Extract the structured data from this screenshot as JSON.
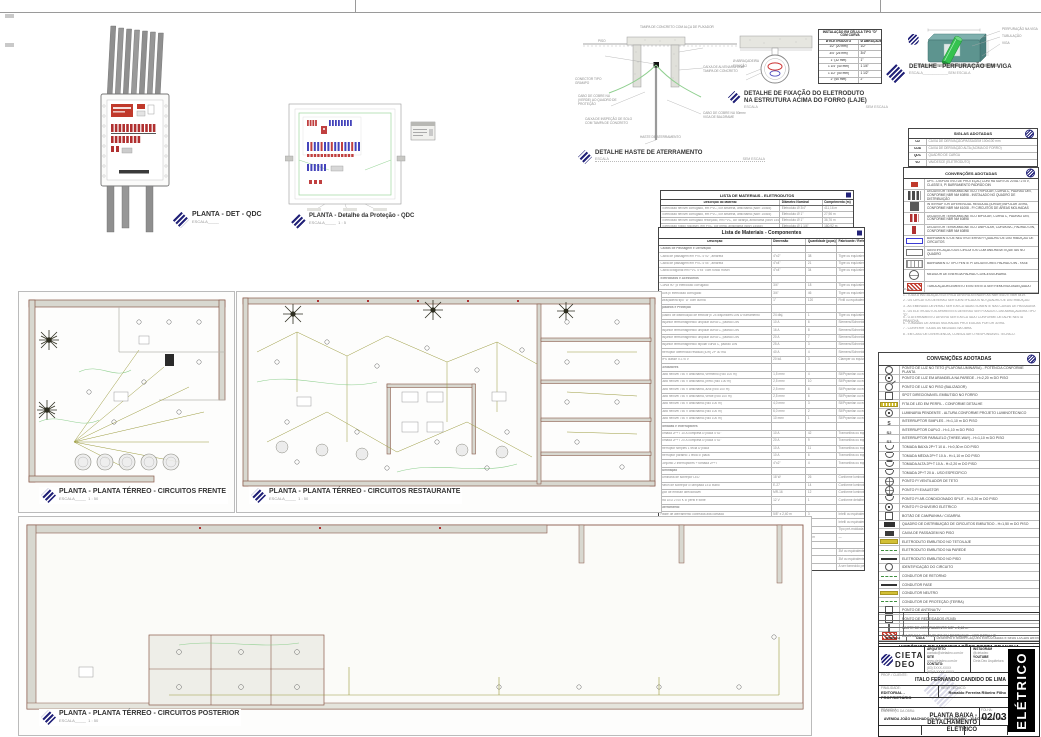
{
  "colors": {
    "accent_navy": "#232379",
    "breaker_red": "#b03030",
    "breaker_blue": "#4444bb",
    "wire_olive": "#9a9a3c",
    "wire_green": "#8fcf8f",
    "wall_brown": "#8a5a4a",
    "beam_teal": "#5d948f",
    "pipe_green": "#35c24f"
  },
  "top_details": {
    "qdc": {
      "title": "PLANTA - DET - QDC",
      "scale": "ESCALA_____"
    },
    "protecao": {
      "title": "PLANTA - Detalhe da Proteção - QDC",
      "scale": "ESCALA_____",
      "scale_value": "1 : 5"
    },
    "haste": {
      "title": "DETALHE HASTE DE ATERRAMENTO",
      "scale_left": "ESCALA",
      "scale_right": "SEM ESCALA",
      "labels": [
        "TAMPA DE CONCRETO COM ALÇA DE PUXADOR",
        "PISO",
        "CONECTOR TIPO GRAMPO",
        "CABO DE COBRE NU (VERDE) AO QUADRO DE PROTEÇÃO",
        "CAIXA DE INSPEÇÃO DE SOLO COM TAMPA DE CONCRETO",
        "CAIXA DE ALVENARIA COM TAMPA DE CONCRETO",
        "CABO DE COBRE NU 50mm² VIGA DE BALDRAME",
        "HASTE DE ATERRAMENTO"
      ]
    },
    "fixacao": {
      "title1": "DETALHE DE FIXAÇÃO DO ELETRODUTO",
      "title2": "NA ESTRUTURA ACIMA DO FORRO (LAJE)",
      "scale_left": "ESCALA",
      "scale_right": "SEM ESCALA",
      "label_left1": "Ø ABRAÇADEIRA",
      "label_left2": "FIXAÇÃO",
      "table": {
        "header": "INSTALAÇÃO EM CÉLULA TIPO \"D\" COM CURVA",
        "col1": "Ø ELETRODUTO",
        "col2": "Ø ABRAÇADEIRA",
        "rows": [
          {
            "e": "1/2\" (20 mm)",
            "a": "1/2\""
          },
          {
            "e": "3/4\" (25 mm)",
            "a": "3/4\""
          },
          {
            "e": "1\" (32 mm)",
            "a": "1\""
          },
          {
            "e": "1 1/4\" (40 mm)",
            "a": "1 1/4\""
          },
          {
            "e": "1 1/2\" (50 mm)",
            "a": "1 1/2\""
          },
          {
            "e": "2\" (60 mm)",
            "a": "2\""
          }
        ]
      }
    },
    "viga": {
      "title": "DETALHE - PERFURAÇÃO EM VIGA",
      "scale_left": "ESCALA_____________",
      "scale_right": "SEM ESCALA",
      "labels": [
        "PERFURAÇÃO NA VIGA",
        "TUBULAÇÃO",
        "VIGA"
      ]
    }
  },
  "plans": {
    "frente": {
      "title": "PLANTA - PLANTA TÉRREO - CIRCUITOS FRENTE",
      "scale": "ESCALA_____",
      "scale_value": "1 : 50"
    },
    "restaurante": {
      "title": "PLANTA - PLANTA TÉRREO - CIRCUITOS RESTAURANTE",
      "scale": "ESCALA_____",
      "scale_value": "1 : 50"
    },
    "posterior": {
      "title": "PLANTA - PLANTA TÉRREO - CIRCUITOS POSTERIOR",
      "scale": "ESCALA_____",
      "scale_value": "1 : 50"
    }
  },
  "materials_eletrodutos": {
    "title": "LISTA DE MATERIAIS - ELETRODUTOS",
    "headers": [
      "Descrição do Material",
      "Diâmetro Nominal",
      "Comprimento (m)"
    ],
    "rows": [
      {
        "d": "Eletroduto flexível corrugado, em PVC, cor amarela, antichama (NBR 15465)",
        "n": "Eletroduto Ø 3/4\"",
        "c": "411,16 m"
      },
      {
        "d": "Eletroduto flexível corrugado, em PVC, cor amarela, antichama (NBR 15465)",
        "n": "Eletroduto Ø 1\"",
        "c": "27,96 m"
      },
      {
        "d": "Eletroduto flexível corrugado reforçado, em PVC, cor laranja, antichama (NBR 15465)",
        "n": "Eletroduto Ø 1\"",
        "c": "36,76 m"
      },
      {
        "d": "Eletroduto rígido roscável, em PVC, cor preta, antichama (NBR 15465)",
        "n": "Eletroduto Ø 1 1/4\"",
        "c": "180,92 m"
      }
    ]
  },
  "materials_componentes": {
    "title": "Lista de Materiais - Componentes",
    "headers": [
      "Descrição",
      "Dimensão",
      "Quantidade (pças)",
      "Fabricante / Referência"
    ],
    "rows": [
      {
        "t": "sec",
        "d": "Caixas de Passagem e Derivação",
        "m": "",
        "q": "",
        "r": ""
      },
      {
        "t": "i",
        "d": "Caixa de passagem em PVC 4\"x2\", amarela",
        "m": "4\"x2\"",
        "q": "38",
        "r": "Tigre ou equivalente"
      },
      {
        "t": "i",
        "d": "Caixa de passagem em PVC 4\"x4\", amarela",
        "m": "4\"x4\"",
        "q": "21",
        "r": "Tigre ou equivalente"
      },
      {
        "t": "i",
        "d": "Caixa octogonal em PVC 4\"x4\" com fundo móvel",
        "m": "4\"x4\"",
        "q": "34",
        "r": "Tigre ou equivalente"
      },
      {
        "t": "sec",
        "d": "Eletrodutos e Acessórios",
        "m": "",
        "q": "",
        "r": ""
      },
      {
        "t": "i",
        "d": "Curva 90° p/ eletroduto corrugado",
        "m": "3/4\"",
        "q": "18",
        "r": "Tigre ou equivalente"
      },
      {
        "t": "i",
        "d": "Luva p/ eletroduto corrugado",
        "m": "3/4\"",
        "q": "46",
        "r": "Tigre ou equivalente"
      },
      {
        "t": "i",
        "d": "Abraçadeira tipo \"D\" com cunha",
        "m": "1\"",
        "q": "120",
        "r": "Fixtil ou equivalente"
      },
      {
        "t": "sec",
        "d": "Quadros e Proteção",
        "m": "",
        "q": "",
        "r": ""
      },
      {
        "t": "i",
        "d": "Quadro de distribuição de embutir p/ 24 disjuntores DIN c/ barramento",
        "m": "24 disj.",
        "q": "1",
        "r": "Tigre ou equivalente"
      },
      {
        "t": "i",
        "d": "Disjuntor termomagnético unipolar curva C, padrão DIN",
        "m": "10 A",
        "q": "6",
        "r": "Siemens/Schneider ou equiv."
      },
      {
        "t": "i",
        "d": "Disjuntor termomagnético unipolar curva C, padrão DIN",
        "m": "16 A",
        "q": "8",
        "r": "Siemens/Schneider ou equiv."
      },
      {
        "t": "i",
        "d": "Disjuntor termomagnético unipolar curva C, padrão DIN",
        "m": "20 A",
        "q": "7",
        "r": "Siemens/Schneider ou equiv."
      },
      {
        "t": "i",
        "d": "Disjuntor termomagnético bipolar curva C, padrão DIN",
        "m": "25 A",
        "q": "3",
        "r": "Siemens/Schneider ou equiv."
      },
      {
        "t": "i",
        "d": "Interruptor diferencial residual (IDR) 2P 30 mA",
        "m": "40 A",
        "q": "4",
        "r": "Siemens/Schneider ou equiv."
      },
      {
        "t": "i",
        "d": "DPS classe II 275 V",
        "m": "20 kA",
        "q": "3",
        "r": "Clamper ou equivalente"
      },
      {
        "t": "sec",
        "d": "Condutores",
        "m": "",
        "q": "",
        "r": ""
      },
      {
        "t": "i",
        "d": "Cabo flexível 750 V antichama, vermelho (rolo 100 m)",
        "m": "1,5 mm²",
        "q": "4",
        "r": "Sil/Prysmian ou equivalente"
      },
      {
        "t": "i",
        "d": "Cabo flexível 750 V antichama, preto (rolo 100 m)",
        "m": "2,5 mm²",
        "q": "10",
        "r": "Sil/Prysmian ou equivalente"
      },
      {
        "t": "i",
        "d": "Cabo flexível 750 V antichama, azul (rolo 100 m)",
        "m": "2,5 mm²",
        "q": "6",
        "r": "Sil/Prysmian ou equivalente"
      },
      {
        "t": "i",
        "d": "Cabo flexível 750 V antichama, verde (rolo 100 m)",
        "m": "2,5 mm²",
        "q": "6",
        "r": "Sil/Prysmian ou equivalente"
      },
      {
        "t": "i",
        "d": "Cabo flexível 750 V antichama (rolo 100 m)",
        "m": "4,0 mm²",
        "q": "3",
        "r": "Sil/Prysmian ou equivalente"
      },
      {
        "t": "i",
        "d": "Cabo flexível 750 V antichama (rolo 100 m)",
        "m": "6,0 mm²",
        "q": "2",
        "r": "Sil/Prysmian ou equivalente"
      },
      {
        "t": "i",
        "d": "Cabo flexível 750 V antichama (rolo 100 m)",
        "m": "10 mm²",
        "q": "1",
        "r": "Sil/Prysmian ou equivalente"
      },
      {
        "t": "sec",
        "d": "Tomadas e Interruptores",
        "m": "",
        "q": "",
        "r": ""
      },
      {
        "t": "i",
        "d": "Tomada 2P+T 10 A completa c/ placa 4\"x2\"",
        "m": "10 A",
        "q": "42",
        "r": "Tramontina ou equivalente"
      },
      {
        "t": "i",
        "d": "Tomada 2P+T 20 A completa c/ placa 4\"x2\"",
        "m": "20 A",
        "q": "9",
        "r": "Tramontina ou equivalente"
      },
      {
        "t": "i",
        "d": "Interruptor simples 1 tecla c/ placa",
        "m": "10 A",
        "q": "11",
        "r": "Tramontina ou equivalente"
      },
      {
        "t": "i",
        "d": "Interruptor paralelo 1 tecla c/ placa",
        "m": "10 A",
        "q": "6",
        "r": "Tramontina ou equivalente"
      },
      {
        "t": "i",
        "d": "Conjunto 2 interruptores + tomada 2P+T",
        "m": "4\"x2\"",
        "q": "4",
        "r": "Tramontina ou equivalente"
      },
      {
        "t": "sec",
        "d": "Iluminação",
        "m": "",
        "q": "",
        "r": ""
      },
      {
        "t": "i",
        "d": "Luminária de sobrepor LED",
        "m": "18 W",
        "q": "26",
        "r": "Conforme luminotécnico"
      },
      {
        "t": "i",
        "d": "Plafon de sobrepor c/ lâmpada LED bulbo",
        "m": "E-27",
        "q": "14",
        "r": "Conforme luminotécnico"
      },
      {
        "t": "i",
        "d": "Spot de embutir direcionável",
        "m": "MR-16",
        "q": "12",
        "r": "Conforme luminotécnico"
      },
      {
        "t": "i",
        "d": "Fita LED 2700 K c/ perfil e fonte",
        "m": "12 V",
        "q": "1",
        "r": "Conforme detalhe"
      },
      {
        "t": "sec",
        "d": "Aterramento",
        "m": "",
        "q": "",
        "r": ""
      },
      {
        "t": "i",
        "d": "Haste de aterramento cobreada alta camada",
        "m": "5/8\" x 2,40 m",
        "q": "3",
        "r": "Intelli ou equivalente"
      },
      {
        "t": "i",
        "d": "Conector tipo grampo p/ haste 5/8\"",
        "m": "5/8\"",
        "q": "3",
        "r": "Intelli ou equivalente"
      },
      {
        "t": "i",
        "d": "Caixa de inspeção de solo c/ tampa",
        "m": "Ø 300 mm",
        "q": "3",
        "r": "Tipo pré-moldada"
      },
      {
        "t": "i",
        "d": "Cabo de cobre nu",
        "m": "50 mm²",
        "q": "15 m",
        "r": "—"
      },
      {
        "t": "sec",
        "d": "Diversos",
        "m": "",
        "q": "",
        "r": ""
      },
      {
        "t": "i",
        "d": "Fita isolante antichama 19 mm x 20 m",
        "m": "19 mm",
        "q": "10",
        "r": "3M ou equivalente"
      },
      {
        "t": "i",
        "d": "Fita isolante de autofusão 19 mm x 10 m",
        "m": "19 mm",
        "q": "2",
        "r": "3M ou equivalente"
      },
      {
        "t": "i",
        "d": "Quadro p/ medição padrão concessionária",
        "m": "CP-1",
        "q": "1",
        "r": "A ser fornecido pelo responsável"
      }
    ]
  },
  "siglas": {
    "title": "SIGLAS ADOTADAS",
    "rows": [
      {
        "a": "CD",
        "d": "CAIXA DE DERIVAÇÃO/PASSAGEM 100x100 mm"
      },
      {
        "a": "CDA",
        "d": "CAIXA DE DERIVAÇÃO ALTA (ACIMA DO FORRO)"
      },
      {
        "a": "QDC",
        "d": "QUADRO DE CARGA"
      },
      {
        "a": "VD",
        "d": "VAI/DESCE (ELETRODUTO)"
      }
    ]
  },
  "convencoes_top": {
    "title": "CONVENÇÕES ADOTADAS",
    "rows": [
      {
        "sym": "sy-dps",
        "text": "DPS - DISPOSITIVO DE PROTEÇÃO CONTRA SURTOS 20 kA / 275 V, CLASSE II, P/ BARRAMENTO PADRÃO DIN"
      },
      {
        "sym": "sy-bk3",
        "text": "DISJUNTOR TERMOMAGNÉTICO TRIPOLAR, CURVA C, PADRÃO DIN, CONFORME NBR NM 60898 - INSTALADO NO QUADRO DE DISTRIBUIÇÃO"
      },
      {
        "sym": "sy-dr",
        "text": "INTERRUPTOR DIFERENCIAL RESIDUAL (IDR/DR) BIPOLAR 30 mA, CONFORME NBR NM 61008 - P/ CIRCUITOS DE ÁREAS MOLHADAS"
      },
      {
        "sym": "sy-bk2",
        "text": "DISJUNTOR TERMOMAGNÉTICO BIPOLAR, CURVA C, PADRÃO DIN, CONFORME NBR NM 60898"
      },
      {
        "sym": "sy-bk1",
        "text": "DISJUNTOR TERMOMAGNÉTICO UNIPOLAR, CURVA B/C, PADRÃO DIN, CONFORME NBR NM 60898"
      },
      {
        "sym": "sy-bus",
        "text": "BARRAMENTO DE NEUTRO/TERRA P/ QUADRO DE DISTRIBUIÇÃO DE CIRCUITOS"
      },
      {
        "sym": "sy-lab",
        "text": "IDENTIFICAÇÃO DOS CIRCUITOS COM ANILHAS/ETIQUETAS NO QUADRO"
      },
      {
        "sym": "sy-din",
        "text": "BARRAMENTO TIPO PENTE P/ DISJUNTORES PADRÃO DIN - FASE"
      },
      {
        "sym": "sy-met",
        "text": "MEDIDOR DE ENERGIA PADRÃO CONCESSIONÁRIA"
      },
      {
        "sym": "sy-hat",
        "text": "TUBULAÇÃO/ELEMENTO EXISTENTE A SER REMOVIDO/ADEQUADO"
      }
    ]
  },
  "notes": {
    "lines": [
      "NOTAS:",
      "1 - TODA A INSTALAÇÃO ELÉTRICA DEVERÁ ATENDER ÀS NBR 5410 E NBR 5419.",
      "2 - OS CIRCUITOS DEVERÃO SER IDENTIFICADOS NO QUADRO DE DISTRIBUIÇÃO.",
      "3 - AS EMENDAS DEVERÃO SER EXECUTADAS SOMENTE NAS CAIXAS DE PASSAGEM.",
      "4 - OS ELETRODUTOS APARENTES DEVERÃO SER FIXADOS COM ABRAÇADEIRA TIPO \"D\".",
      "5 - O ATERRAMENTO DEVERÁ SER EXECUTADO CONFORME DETALHE NESTA PRANCHA.",
      "6 - TOMADAS DE ÁREAS MOLHADAS PROTEGIDAS POR DR 30 mA.",
      "7 - CONFERIR TODAS AS MEDIDAS NA OBRA.",
      "8 - EM CASO DE DIVERGÊNCIA, CONSULTAR O RESPONSÁVEL TÉCNICO."
    ]
  },
  "convencoes_main": {
    "title": "CONVENÇÕES ADOTADAS",
    "rows": [
      {
        "sym": "sy-c",
        "text": "PONTO DE LUZ NO TETO (PLAFON/LUMINÁRIA) - POTÊNCIA CONFORME PLANTA"
      },
      {
        "sym": "sy-cd",
        "text": "PONTO DE LUZ EM ARANDELA NA PAREDE - H=2,20 m DO PISO"
      },
      {
        "sym": "sy-ca",
        "text": "PONTO DE LUZ NO PISO (BALIZADOR)"
      },
      {
        "sym": "sy-sq",
        "text": "SPOT DIRECIONÁVEL EMBUTIDO NO FORRO"
      },
      {
        "sym": "sy-led",
        "text": "FITA DE LED EM PERFIL - CONFORME DETALHE"
      },
      {
        "sym": "sy-cd",
        "text": "LUMINÁRIA PENDENTE - ALTURA CONFORME PROJETO LUMINOTÉCNICO"
      },
      {
        "sym": "sy-s",
        "text": "INTERRUPTOR SIMPLES - H=1,10 m DO PISO"
      },
      {
        "sym": "sy-s2",
        "text": "INTERRUPTOR DUPLO - H=1,10 m DO PISO"
      },
      {
        "sym": "sy-s3",
        "text": "INTERRUPTOR PARALELO (THREE-WAY) - H=1,10 m DO PISO"
      },
      {
        "sym": "sy-out",
        "text": "TOMADA BAIXA 2P+T 10 A - H=0,30 m DO PISO"
      },
      {
        "sym": "sy-outm",
        "text": "TOMADA MÉDIA 2P+T 10 A - H=1,10 m DO PISO"
      },
      {
        "sym": "sy-outh",
        "text": "TOMADA ALTA 2P+T 10 A - H=2,20 m DO PISO"
      },
      {
        "sym": "sy-outm",
        "text": "TOMADA 2P+T 20 A - USO ESPECÍFICO"
      },
      {
        "sym": "sy-fan",
        "text": "PONTO P/ VENTILADOR DE TETO"
      },
      {
        "sym": "sy-fan",
        "text": "PONTO P/ EXAUSTOR"
      },
      {
        "sym": "sy-outh",
        "text": "PONTO P/ AR-CONDICIONADO SPLIT - H=2,20 m DO PISO"
      },
      {
        "sym": "sy-cd",
        "text": "PONTO P/ CHUVEIRO ELÉTRICO"
      },
      {
        "sym": "sy-sq",
        "text": "BOTÃO DE CAMPAINHA / CIGARRA"
      },
      {
        "sym": "sy-panel",
        "text": "QUADRO DE DISTRIBUIÇÃO DE CIRCUITOS EMBUTIDO - H=1,50 m DO PISO"
      },
      {
        "sym": "sy-sqf",
        "text": "CAIXA DE PASSAGEM NO PISO"
      },
      {
        "sym": "sy-bar-y",
        "text": "ELETRODUTO EMBUTIDO NO TETO/LAJE"
      },
      {
        "sym": "sy-bar-g",
        "text": "ELETRODUTO EMBUTIDO NA PAREDE"
      },
      {
        "sym": "sy-bar-b",
        "text": "ELETRODUTO EMBUTIDO NO PISO"
      },
      {
        "sym": "sy-c",
        "text": "IDENTIFICAÇÃO DO CIRCUITO"
      },
      {
        "sym": "sy-bar-g",
        "text": "CONDUTOR DE RETORNO"
      },
      {
        "sym": "sy-bar-b",
        "text": "CONDUTOR FASE"
      },
      {
        "sym": "sy-bar-y",
        "text": "CONDUTOR NEUTRO"
      },
      {
        "sym": "sy-bar-g",
        "text": "CONDUTOR DE PROTEÇÃO (TERRA)"
      },
      {
        "sym": "sy-sq",
        "text": "PONTO DE ANTENA/TV"
      },
      {
        "sym": "sy-sq",
        "text": "PONTO DE REDE/DADOS (RJ45)"
      },
      {
        "sym": "sy-rod",
        "text": "HASTE DE ATERRAMENTO 5/8\" x 2,40 m"
      },
      {
        "sym": "sy-hat",
        "text": "DIAGRAMA / ELEMENTO EM DESTAQUE - VER DETALHE"
      }
    ]
  },
  "historico": {
    "col_simbolo": "SÍMBOLO",
    "col_data": "DATA",
    "col_desc": "DESENHO E MODIFICAÇÕES EXECUTADAS E SEUS LOCAIS ANTERIORES",
    "title": "HISTÓRICO DE MODIFICAÇÕES DESTA PRANCHA"
  },
  "titleblock": {
    "brand1": "CIETA",
    "brand2": "DEO",
    "contact": {
      "l1": "ARQUITETO",
      "v1": "contato@cietadeo.com.br",
      "l2": "SITE",
      "v2": "www.cietadeo.com.br",
      "l3": "CONTATO:",
      "v3": "(83) 3XXX-XXXX",
      "v3b": "(83) 9 XXXX-XXXX",
      "l4": "INSTAGRAM",
      "v4": "@cietadeo",
      "l5": "YOUTUBE",
      "v5": "Cieta Deo Arquitetura"
    },
    "client_label": "PROP. / CLIENTE:",
    "client": "ITALO FERNANDO CANDIDO DE LIMA",
    "row2a_label": "FINALIDADE:",
    "row2a": "EDITORIAL - PROPRIETÁRIO",
    "row2b_label": "RESP. TÉCNICO:",
    "row2b": "Ronaldo Ferreira Ribeiro Filho",
    "address_label": "ENDEREÇO DA OBRA:",
    "address": "AVENIDA JOÃO MACHADO Nº 911 - VARADOURO - JOÃO PESSOA - PB",
    "sheet_label": "PRANCHA:",
    "sheet_title1": "PLANTA BAIXA - DETALHAMENTO",
    "sheet_title2": "ELÉTRICO",
    "folha_label": "FOLHA:",
    "folha": "02/03",
    "foot": [
      {
        "label": "REVISÃO:",
        "value": "MEDIAÇÃO"
      },
      {
        "label": "DESENHO:",
        "value": "WAGNER OLIVEIRA"
      },
      {
        "label": "USO:",
        "value": "COMERCIAL"
      }
    ],
    "vertical": "ELÉTRICO"
  }
}
